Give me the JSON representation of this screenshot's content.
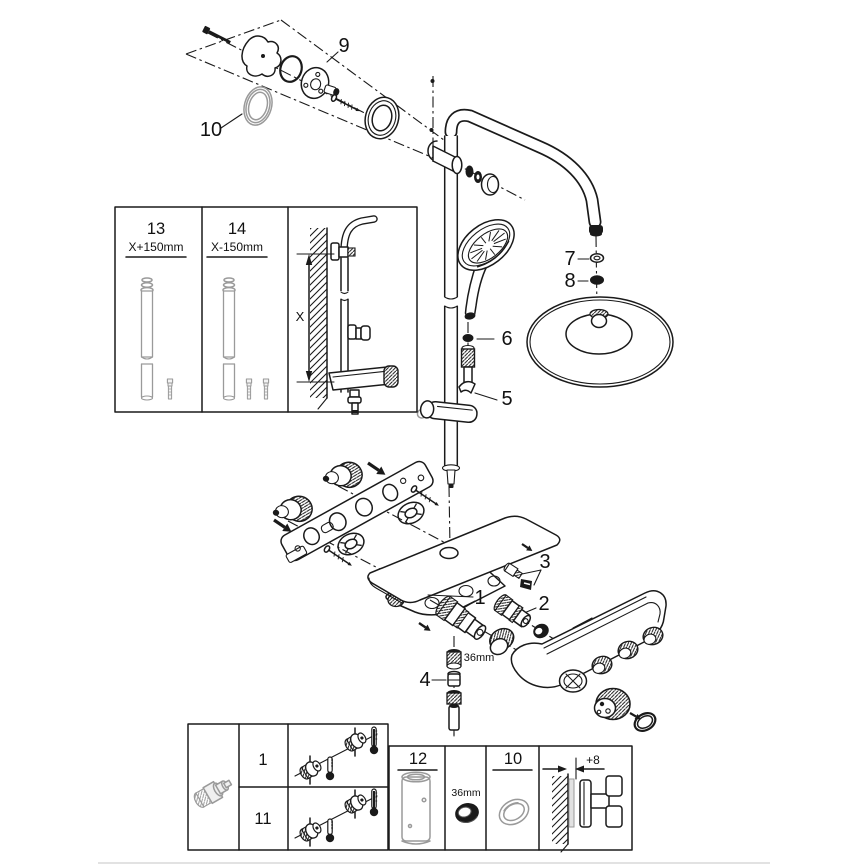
{
  "page": {
    "background": "#ffffff",
    "divider_color": "#d9d9d9",
    "ink_color": "#1a1a1a",
    "grey_part_color": "#9a9a9a"
  },
  "callouts": {
    "part9": "9",
    "part10": "10",
    "part7": "7",
    "part8": "8",
    "part6": "6",
    "part5": "5",
    "part3": "3",
    "part2": "2",
    "part1": "1",
    "part4": "4",
    "ring_size": "36mm"
  },
  "length_inset": {
    "col13_part": "13",
    "col13_length": "X+150mm",
    "col14_part": "14",
    "col14_length": "X-150mm",
    "dimension": "X"
  },
  "parts_table": {
    "row_top": "1",
    "row_bottom": "11",
    "sleeve_cell": "12",
    "ring_size": "36mm",
    "seal_cell": "10",
    "wall_offset": "+8"
  }
}
